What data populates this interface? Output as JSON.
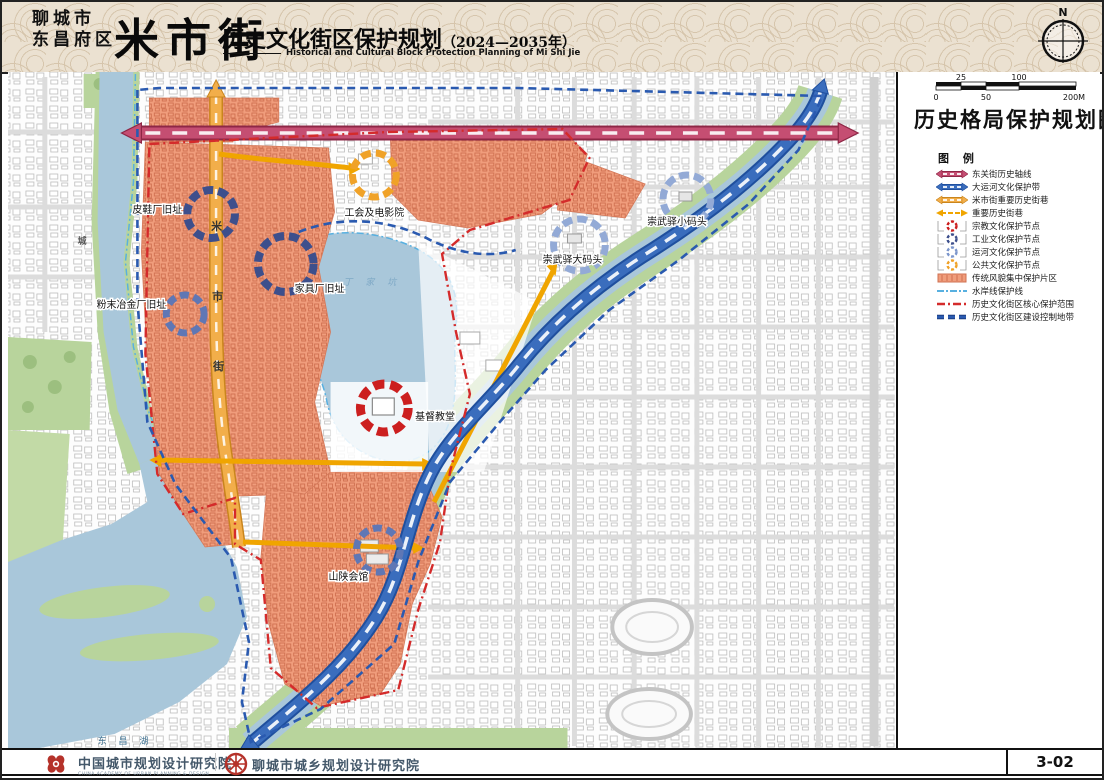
{
  "header": {
    "city": "聊城市",
    "district": "东昌府区",
    "block_name": "米市街",
    "title": "历史文化街区保护规划",
    "period": "（2024—2035年）",
    "title_en": "Historical and Cultural Block Protection Planning of Mi Shi Jie",
    "north_label": "N"
  },
  "panel": {
    "map_title": "历史格局保护规划图",
    "legend_title": "图 例",
    "scale": {
      "above": [
        "25",
        "100"
      ],
      "below": [
        "0",
        "50",
        "200M"
      ]
    },
    "legend": [
      {
        "label": "东关街历史轴线",
        "type": "axis-band",
        "color": "#c54e72"
      },
      {
        "label": "大运河文化保护带",
        "type": "axis-band",
        "color": "#3a6dbd"
      },
      {
        "label": "米市街重要历史街巷",
        "type": "axis-band",
        "color": "#f2ae4a"
      },
      {
        "label": "重要历史街巷",
        "type": "arrow-line",
        "color": "#f0a500"
      },
      {
        "label": "宗教文化保护节点",
        "type": "dashed-circle",
        "color": "#cc1f1f"
      },
      {
        "label": "工业文化保护节点",
        "type": "dashed-circle",
        "color": "#3d4f8c"
      },
      {
        "label": "运河文化保护节点",
        "type": "dashed-circle",
        "color": "#7c96cc"
      },
      {
        "label": "公共文化保护节点",
        "type": "dashed-circle",
        "color": "#f0a228"
      },
      {
        "label": "传统风貌集中保护片区",
        "type": "hatched-area",
        "color": "#f09d7c"
      },
      {
        "label": "水岸线保护线",
        "type": "dashdot-line",
        "color": "#58b0e0"
      },
      {
        "label": "历史文化街区核心保护范围",
        "type": "dashdot-line",
        "color": "#d42b2b"
      },
      {
        "label": "历史文化街区建设控制地带",
        "type": "dashed-line",
        "color": "#2a5ab0"
      }
    ]
  },
  "map": {
    "labels": {
      "pixiechang": "皮鞋厂旧址",
      "fenmo": "粉末冶金厂旧址",
      "jiaju": "家具厂旧址",
      "gonghui": "工会及电影院",
      "xiaomatou": "崇武驿小码头",
      "damatou": "崇武驿大码头",
      "jidujiaotang": "基督教堂",
      "shanshan": "山陕会馆"
    },
    "street_chars": [
      "米",
      "市",
      "街"
    ],
    "road_char": "城",
    "water_labels": {
      "lake": "东昌湖",
      "pond": "丁家坑"
    }
  },
  "footer": {
    "org1": "中国城市规划设计研究院",
    "org1_en": "CHINA ACADEMY OF URBAN PLANNING & DESIGN",
    "org2": "聊城市城乡规划设计研究院",
    "page_no": "3-02"
  },
  "colors": {
    "axis_pink": "#c54e72",
    "canal_blue": "#3a6dbd",
    "street_yellow": "#f2ae4a",
    "historic_area": "#f09d7c",
    "core_boundary_red": "#d42b2b",
    "control_zone_blue": "#2a5ab0",
    "water": "#a9c7da",
    "green": "#b8d49c"
  }
}
